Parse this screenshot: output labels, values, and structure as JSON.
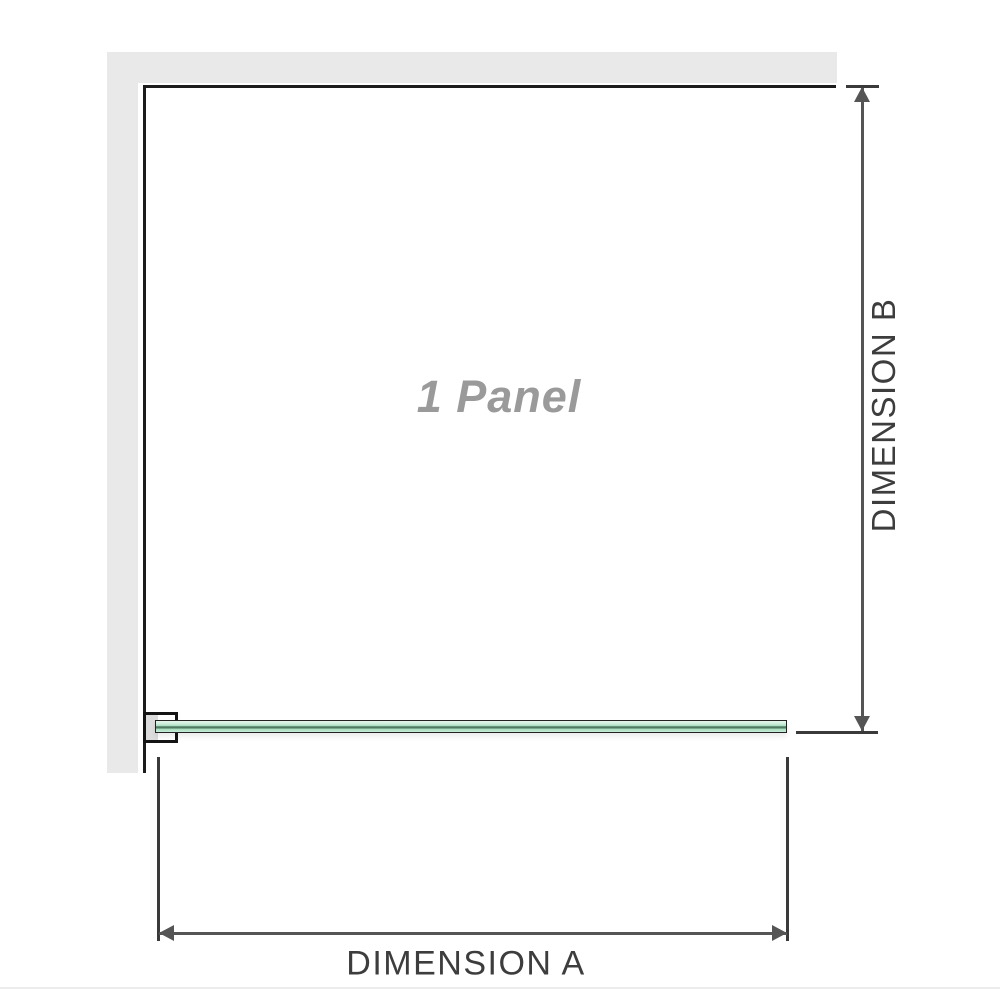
{
  "diagram": {
    "panel_label": "1 Panel",
    "dim_a_label": "DIMENSION A",
    "dim_b_label": "DIMENSION B"
  },
  "icons": {
    "arrow_up": "dimension-b-arrow-up",
    "arrow_down": "dimension-b-arrow-down",
    "arrow_left": "dimension-a-arrow-left",
    "arrow_right": "dimension-a-arrow-right"
  },
  "colors": {
    "wall": "#e9e9e9",
    "outline": "#1c1c1c",
    "dim_line": "#555555",
    "tick": "#3a3a3a",
    "dim_text": "#3d3d3d",
    "panel_text": "#9a9a9a",
    "glass_border": "#222222",
    "glass_light": "#c9ecd8",
    "glass_main": "#a8ddbe",
    "glass_dark": "#4f7a62",
    "clamp_fill": "#ffffff",
    "clamp_inner": "#dcdcdc",
    "divider": "#ececec"
  }
}
